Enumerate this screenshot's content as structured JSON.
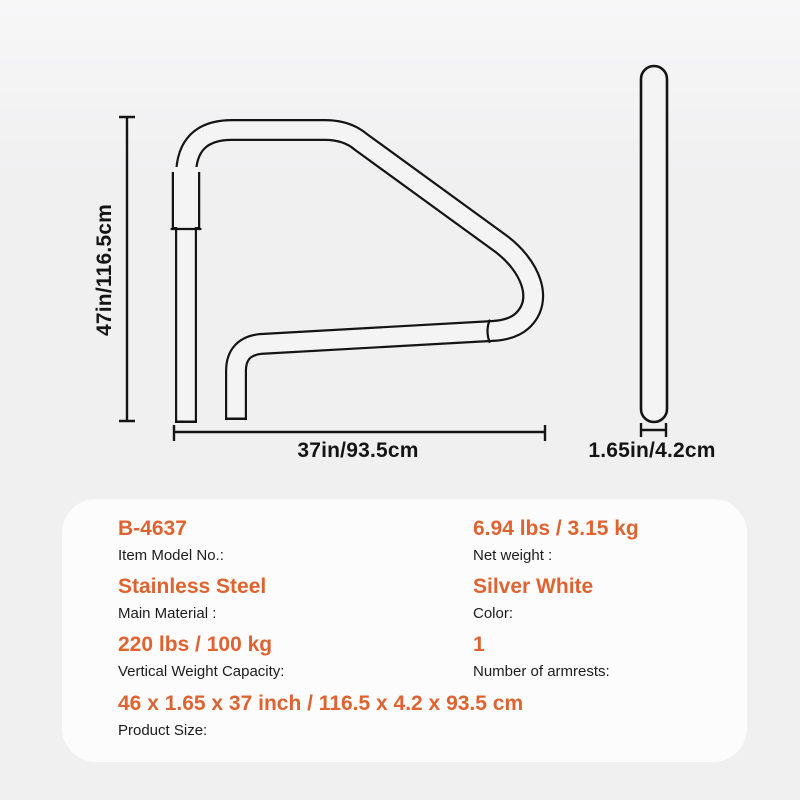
{
  "diagram": {
    "height_dim_label": "47in/116.5cm",
    "width_dim_label": "37in/93.5cm",
    "tube_diameter_label": "1.65in/4.2cm"
  },
  "specs": {
    "item_model": {
      "value": "B-4637",
      "label": "Item Model No.:"
    },
    "net_weight": {
      "value": "6.94 lbs / 3.15 kg",
      "label": "Net weight :"
    },
    "material": {
      "value": "Stainless Steel",
      "label": "Main Material :"
    },
    "color": {
      "value": "Silver White",
      "label": "Color:"
    },
    "capacity": {
      "value": "220 lbs / 100 kg",
      "label": "Vertical Weight Capacity:"
    },
    "armrests": {
      "value": "1",
      "label": "Number of armrests:"
    },
    "size": {
      "value": "46 x 1.65 x 37 inch / 116.5 x 4.2 x 93.5 cm",
      "label": "Product Size:"
    }
  },
  "colors": {
    "accent": "#DF6330",
    "text": "#1c1c1c",
    "line": "#141414",
    "page_bg": "#f0f0f1",
    "panel_bg": "#fcfcfc",
    "tube_fill": "#f4f4f5"
  }
}
